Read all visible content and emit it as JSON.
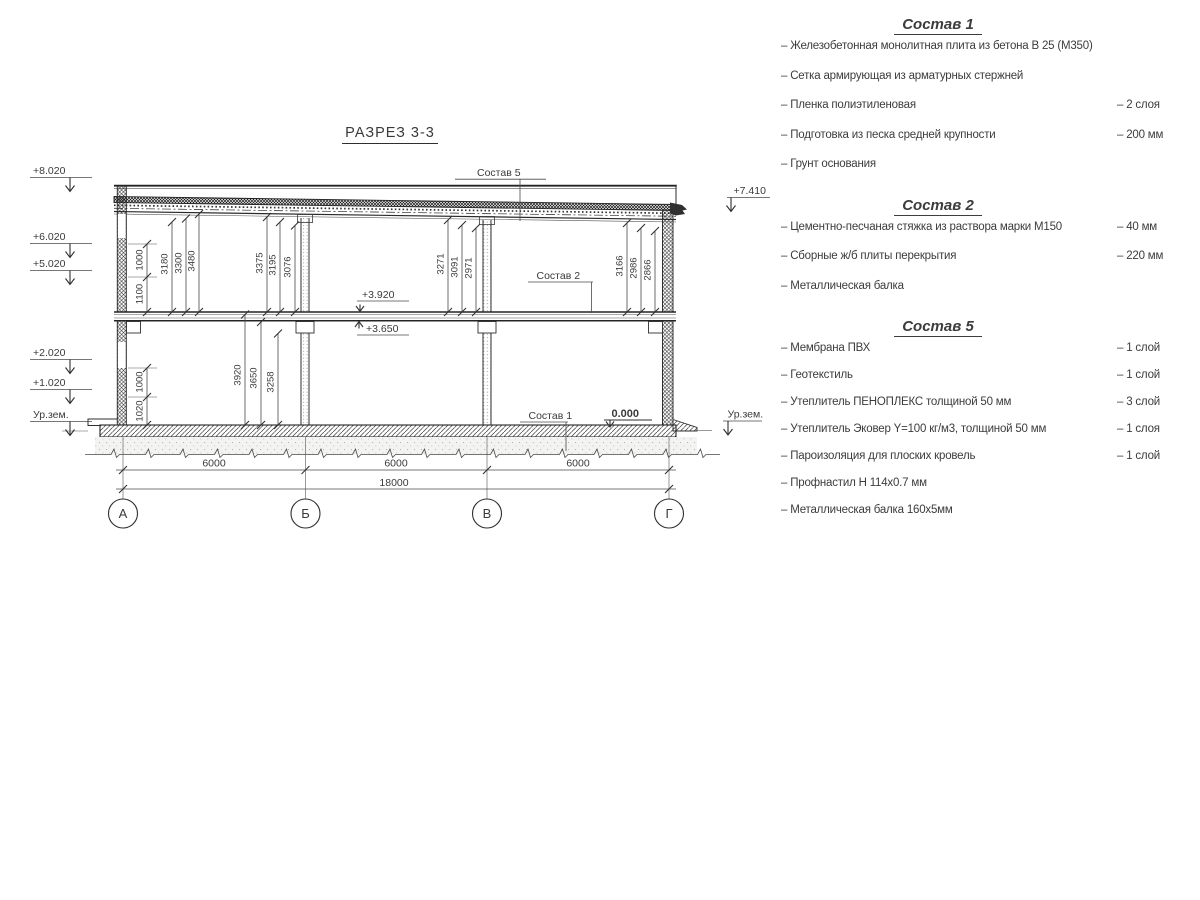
{
  "drawing": {
    "title": "РАЗРЕЗ 3-3",
    "axes": {
      "a": "А",
      "b": "Б",
      "v": "В",
      "g": "Г"
    },
    "hdims": {
      "bay1": "6000",
      "bay2": "6000",
      "bay3": "6000",
      "total": "18000"
    },
    "elevations": {
      "left": [
        "+8.020",
        "+6.020",
        "+5.020",
        "+2.020",
        "+1.020",
        "Ур.зем."
      ],
      "right_top": "+7.410",
      "right_ground": "Ур.зем.",
      "mid_top": "+3.920",
      "mid_bottom": "+3.650",
      "zero": "0.000"
    },
    "leaders": {
      "s5": "Состав 5",
      "s2": "Состав 2",
      "s1": "Состав 1"
    },
    "vdims": {
      "wall_upper": [
        "1000",
        "1100"
      ],
      "wall_lower": [
        "1000",
        "1020"
      ],
      "bay1_upper": [
        "3180",
        "3300",
        "3480"
      ],
      "colB_upper": [
        "3375",
        "3195",
        "3076"
      ],
      "colV_upper": [
        "3271",
        "3091",
        "2971"
      ],
      "colG_upper": [
        "3166",
        "2986",
        "2866"
      ],
      "colB_lower": [
        "3920",
        "3650",
        "3258"
      ]
    }
  },
  "specs": [
    {
      "heading": "Состав 1",
      "items": [
        {
          "text": "– Железобетонная  монолитная плита из бетона В 25 (М350)",
          "value": ""
        },
        {
          "text": "– Сетка армирующая из арматурных стержней",
          "value": ""
        },
        {
          "text": "– Пленка полиэтиленовая",
          "value": "– 2 слоя"
        },
        {
          "text": "– Подготовка из песка средней крупности",
          "value": "– 200 мм"
        },
        {
          "text": "– Грунт основания",
          "value": ""
        }
      ]
    },
    {
      "heading": "Состав 2",
      "items": [
        {
          "text": "– Цементно-песчаная стяжка из раствора марки М150",
          "value": "– 40 мм"
        },
        {
          "text": "– Сборные ж/б плиты перекрытия",
          "value": "– 220 мм"
        },
        {
          "text": "– Металлическая балка",
          "value": ""
        }
      ]
    },
    {
      "heading": "Состав 5",
      "items": [
        {
          "text": "– Мембрана ПВХ",
          "value": "– 1 слой"
        },
        {
          "text": "– Геотекстиль",
          "value": "– 1 слой"
        },
        {
          "text": "– Утеплитель ПЕНОПЛЕКС толщиной 50 мм",
          "value": "– 3 слой"
        },
        {
          "text": "– Утеплитель Эковер Y=100 кг/м3, толщиной 50 мм",
          "value": "– 1 слоя"
        },
        {
          "text": "– Пароизоляция для плоских кровель",
          "value": "– 1 слой"
        },
        {
          "text": "– Профнастил Н 114х0.7 мм",
          "value": ""
        },
        {
          "text": "– Металлическая балка 160х5мм",
          "value": ""
        }
      ]
    }
  ]
}
